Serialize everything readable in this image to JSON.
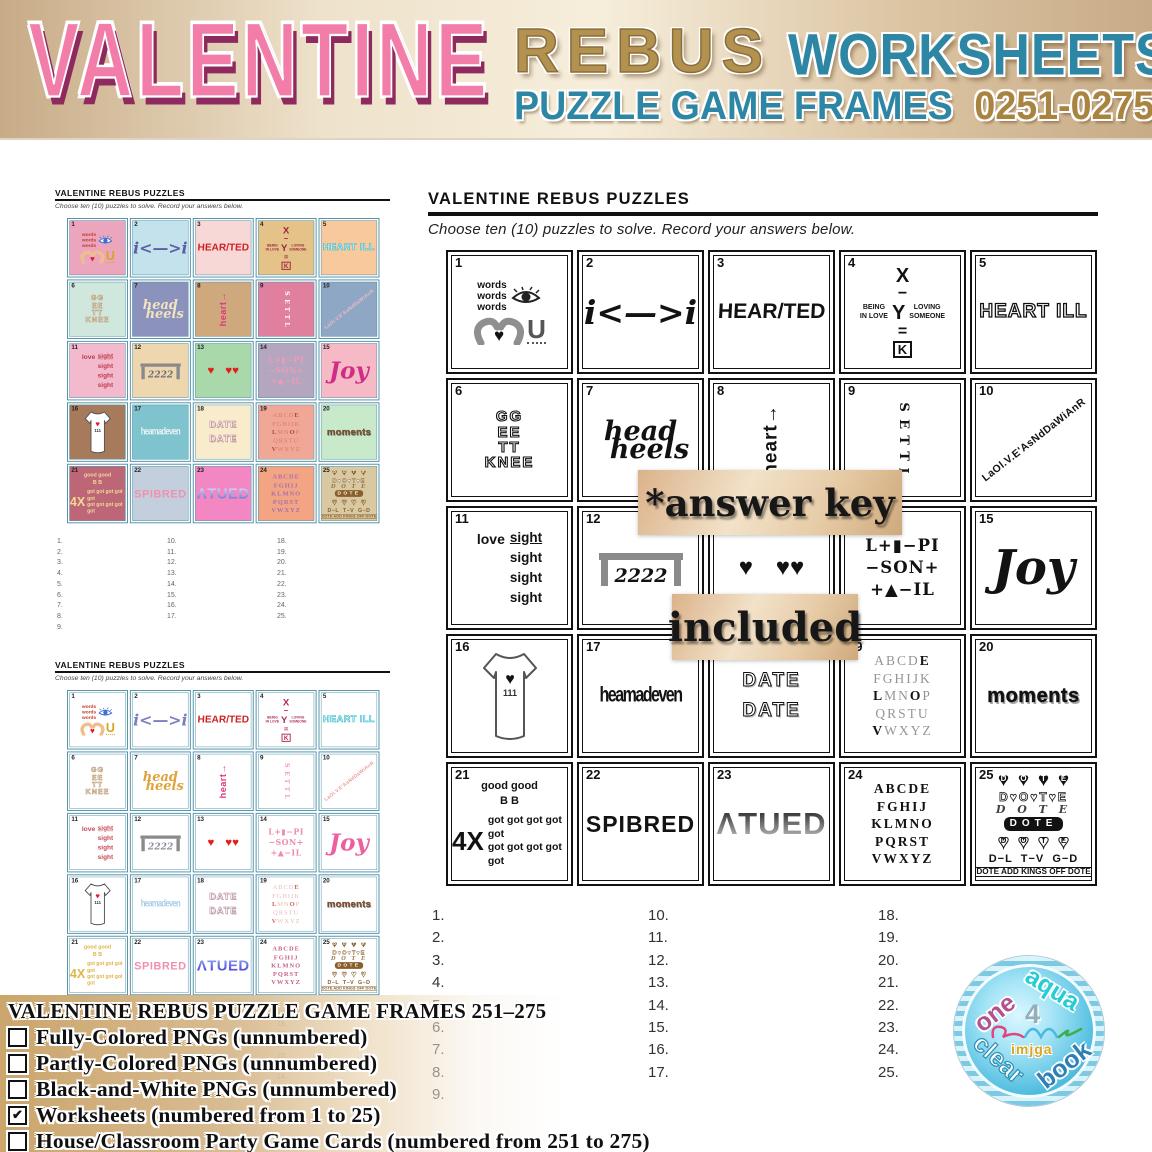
{
  "header": {
    "title_main": "VALENTINE",
    "title_rebus": "REBUS",
    "title_worksheets": "WORKSHEETS",
    "subtitle": "PUZZLE GAME FRAMES",
    "number_range": "0251-0275"
  },
  "sheet": {
    "title": "VALENTINE REBUS PUZZLES",
    "instructions": "Choose ten (10) puzzles to solve. Record your answers below."
  },
  "overlay": {
    "line1": "*answer key",
    "line2": "included"
  },
  "answers": {
    "col1": [
      "1.",
      "2.",
      "3.",
      "4.",
      "5.",
      "6.",
      "7.",
      "8.",
      "9."
    ],
    "col2": [
      "10.",
      "11.",
      "12.",
      "13.",
      "14.",
      "15.",
      "16.",
      "17."
    ],
    "col3": [
      "18.",
      "19.",
      "20.",
      "21.",
      "22.",
      "23.",
      "24.",
      "25."
    ]
  },
  "checklist": {
    "title": "VALENTINE REBUS PUZZLE GAME FRAMES 251–275",
    "items": [
      {
        "label": "Fully-Colored PNGs (unnumbered)",
        "checked": false
      },
      {
        "label": "Partly-Colored PNGs (unnumbered)",
        "checked": false
      },
      {
        "label": "Black-and-White PNGs (unnumbered)",
        "checked": false
      },
      {
        "label": "Worksheets (numbered from 1 to 25)",
        "checked": true
      },
      {
        "label": "House/Classroom Party Game Cards (numbered from 251 to 275)",
        "checked": false
      }
    ],
    "check_glyph": "✔"
  },
  "logo": {
    "arc_top_left": "one",
    "arc_top_right": "aqua",
    "arc_bottom_left": "clear",
    "arc_bottom_right": "book",
    "center": "imjga",
    "numeral": "4"
  },
  "colors": {
    "valentine_pink": "#f27da9",
    "valentine_shadow": "#8e2a5e",
    "rebus_tan": "#b3914f",
    "teal": "#2e86a5",
    "gold": "#a98440",
    "band_tan": "#c9a368",
    "mini_border_teal": "#4f93aa"
  },
  "puzzles": [
    {
      "num": "1",
      "kind": "eye_words",
      "words": [
        "words",
        "words",
        "words"
      ],
      "letter": "U",
      "colors": {
        "bg": "#eba6bd",
        "full": "#c0392b",
        "part": "#c0392b"
      }
    },
    {
      "num": "2",
      "kind": "plain",
      "style": "arrows",
      "text": "i<—>i",
      "colors": {
        "bg": "#c3e2ec",
        "full": "#5b5ea6",
        "part": "#7a7fc0"
      }
    },
    {
      "num": "3",
      "kind": "plain",
      "style": "grunge",
      "text": "HEAR/TED",
      "colors": {
        "bg": "#f8d7d7",
        "full": "#cc2222",
        "part": "#cc2222"
      }
    },
    {
      "num": "4",
      "kind": "xyk",
      "x": "X",
      "minus": "−",
      "y": "Y",
      "equals": "=",
      "k": "K",
      "left": [
        "BEING",
        "IN LOVE"
      ],
      "right": [
        "LOVING",
        "SOMEONE"
      ],
      "colors": {
        "bg": "#e5c388",
        "full": "#9c2542",
        "part": "#b03050"
      }
    },
    {
      "num": "5",
      "kind": "plain",
      "style": "outline",
      "text": "HEART ILL",
      "colors": {
        "bg": "#f9c99e",
        "full": "#2ab9cc",
        "part": "#2ab9cc"
      }
    },
    {
      "num": "6",
      "kind": "stack",
      "style": "outline6",
      "lines": [
        "GG",
        "EE",
        "TT",
        "KNEE"
      ],
      "colors": {
        "bg": "#cfe7dc",
        "full": "#b08d5e",
        "part": "#b08d5e"
      }
    },
    {
      "num": "7",
      "kind": "script",
      "top": "head",
      "bottom": "heels",
      "colors": {
        "bg": "#8b92bc",
        "full": "#f3e3c0",
        "part": "#e0a23a"
      }
    },
    {
      "num": "8",
      "kind": "rotated",
      "text": "heart",
      "arrow": "→",
      "colors": {
        "bg": "#d0a87e",
        "full": "#e0357f",
        "part": "#e0357f"
      }
    },
    {
      "num": "9",
      "kind": "stack",
      "style": "settl",
      "lines": [
        "S",
        "E",
        "T",
        "T",
        "L"
      ],
      "colors": {
        "bg": "#e0809e",
        "full": "#ffffff",
        "part": "#f39ac2"
      }
    },
    {
      "num": "10",
      "kind": "diagonal",
      "text": "LaOl.V.E'AsNdDaWiAnR",
      "colors": {
        "bg": "#8ea7c4",
        "full": "#f0b9c6",
        "part": "#e89f9f"
      }
    },
    {
      "num": "11",
      "kind": "lovesight",
      "word": "love",
      "repeat": "sight",
      "times": 4,
      "colors": {
        "bg": "#f3bacd",
        "full": "#c03a50",
        "part": "#c74a58"
      }
    },
    {
      "num": "12",
      "kind": "table",
      "text": "2222",
      "colors": {
        "bg": "#eed6ae",
        "full": "#6f6f78",
        "part": "#8d93a0"
      }
    },
    {
      "num": "13",
      "kind": "plain",
      "style": "hearts",
      "text": "♥ ♥♥",
      "colors": {
        "bg": "#a9d8ab",
        "full": "#e51c1c",
        "part": "#e51c1c"
      }
    },
    {
      "num": "14",
      "kind": "stack",
      "style": "rebus14",
      "lines": [
        "L+▮−PI",
        "−SON+",
        "+▲−IL"
      ],
      "colors": {
        "bg": "#b5a6bf",
        "full": "#ef9ab8",
        "part": "#f08cae"
      }
    },
    {
      "num": "15",
      "kind": "plain",
      "style": "gothic",
      "text": "Joy",
      "colors": {
        "bg": "#f6bac6",
        "full": "#d12d86",
        "part": "#ee5fa0"
      }
    },
    {
      "num": "16",
      "kind": "shirt",
      "tag": "111",
      "colors": {
        "bg": "#a87a5c",
        "full": "#444444",
        "part": "#444444"
      }
    },
    {
      "num": "17",
      "kind": "plain",
      "style": "dense",
      "text": "heamadeven",
      "colors": {
        "bg": "#7fc3cf",
        "full": "#e8f2f0",
        "part": "#a9cfe8"
      }
    },
    {
      "num": "18",
      "kind": "stack",
      "style": "date",
      "lines": [
        "DATE",
        "DATE"
      ],
      "colors": {
        "bg": "#f9eccd",
        "full": "#c08098",
        "part": "#bb7f9a"
      }
    },
    {
      "num": "19",
      "kind": "alphabet",
      "style": "grey",
      "rows": [
        "ABCDE",
        "FGHIJK",
        "LMNOP",
        "QRSTU",
        "VWXYZ"
      ],
      "highlights": [
        [
          4
        ],
        [],
        [
          0,
          3
        ],
        [],
        [
          0
        ]
      ],
      "colors": {
        "bg": "#f1a795",
        "full": "#b8443c",
        "part": "#c96a56"
      }
    },
    {
      "num": "20",
      "kind": "plain",
      "style": "bubble",
      "text": "moments",
      "colors": {
        "bg": "#c9e9cb",
        "full": "#97552b",
        "part": "#97552b"
      }
    },
    {
      "num": "21",
      "kind": "goodgot",
      "line1": "good good",
      "line2": "B B",
      "big": "4X",
      "got": "got got got got got",
      "colors": {
        "bg": "#bd6677",
        "full": "#f2d992",
        "part": "#dfb54a"
      }
    },
    {
      "num": "22",
      "kind": "plain",
      "style": "dotted",
      "text": "SPIBRED",
      "colors": {
        "bg": "#c4cfdd",
        "full": "#f090b0",
        "part": "#f090b0"
      }
    },
    {
      "num": "23",
      "kind": "plain",
      "style": "gradient",
      "text": "ΛTUED",
      "gradient": {
        "bw": [
          "#151515",
          "#c8c8c8"
        ],
        "full": [
          "#eef4ff",
          "#4a66d0"
        ],
        "part": [
          "#9ab4f0",
          "#3c2ee0"
        ]
      },
      "colors": {
        "bg": "#f287c3",
        "full": "#4a66d0",
        "part": "#4a3cd8"
      }
    },
    {
      "num": "24",
      "kind": "alphabet",
      "style": "fancy",
      "rows": [
        "ABCDE",
        "FGHIJ",
        "KLMNO",
        "PQRST",
        "VWXYZ"
      ],
      "highlights": [
        [],
        [],
        [],
        [],
        []
      ],
      "colors": {
        "bg": "#f2a483",
        "full": "#a86fb0",
        "part": "#c8608a"
      }
    },
    {
      "num": "25",
      "kind": "dote",
      "rows": [
        "DOTE",
        "DOTE",
        "DOTE",
        "DOTE",
        "DOTE"
      ],
      "equation": "D−L  T−V  G−D",
      "caption": "DOTE ADD KINGS OFF DOTE",
      "colors": {
        "bg": "#d9c9a2",
        "full": "#8a5f2a",
        "part": "#8a5f2a"
      }
    }
  ]
}
